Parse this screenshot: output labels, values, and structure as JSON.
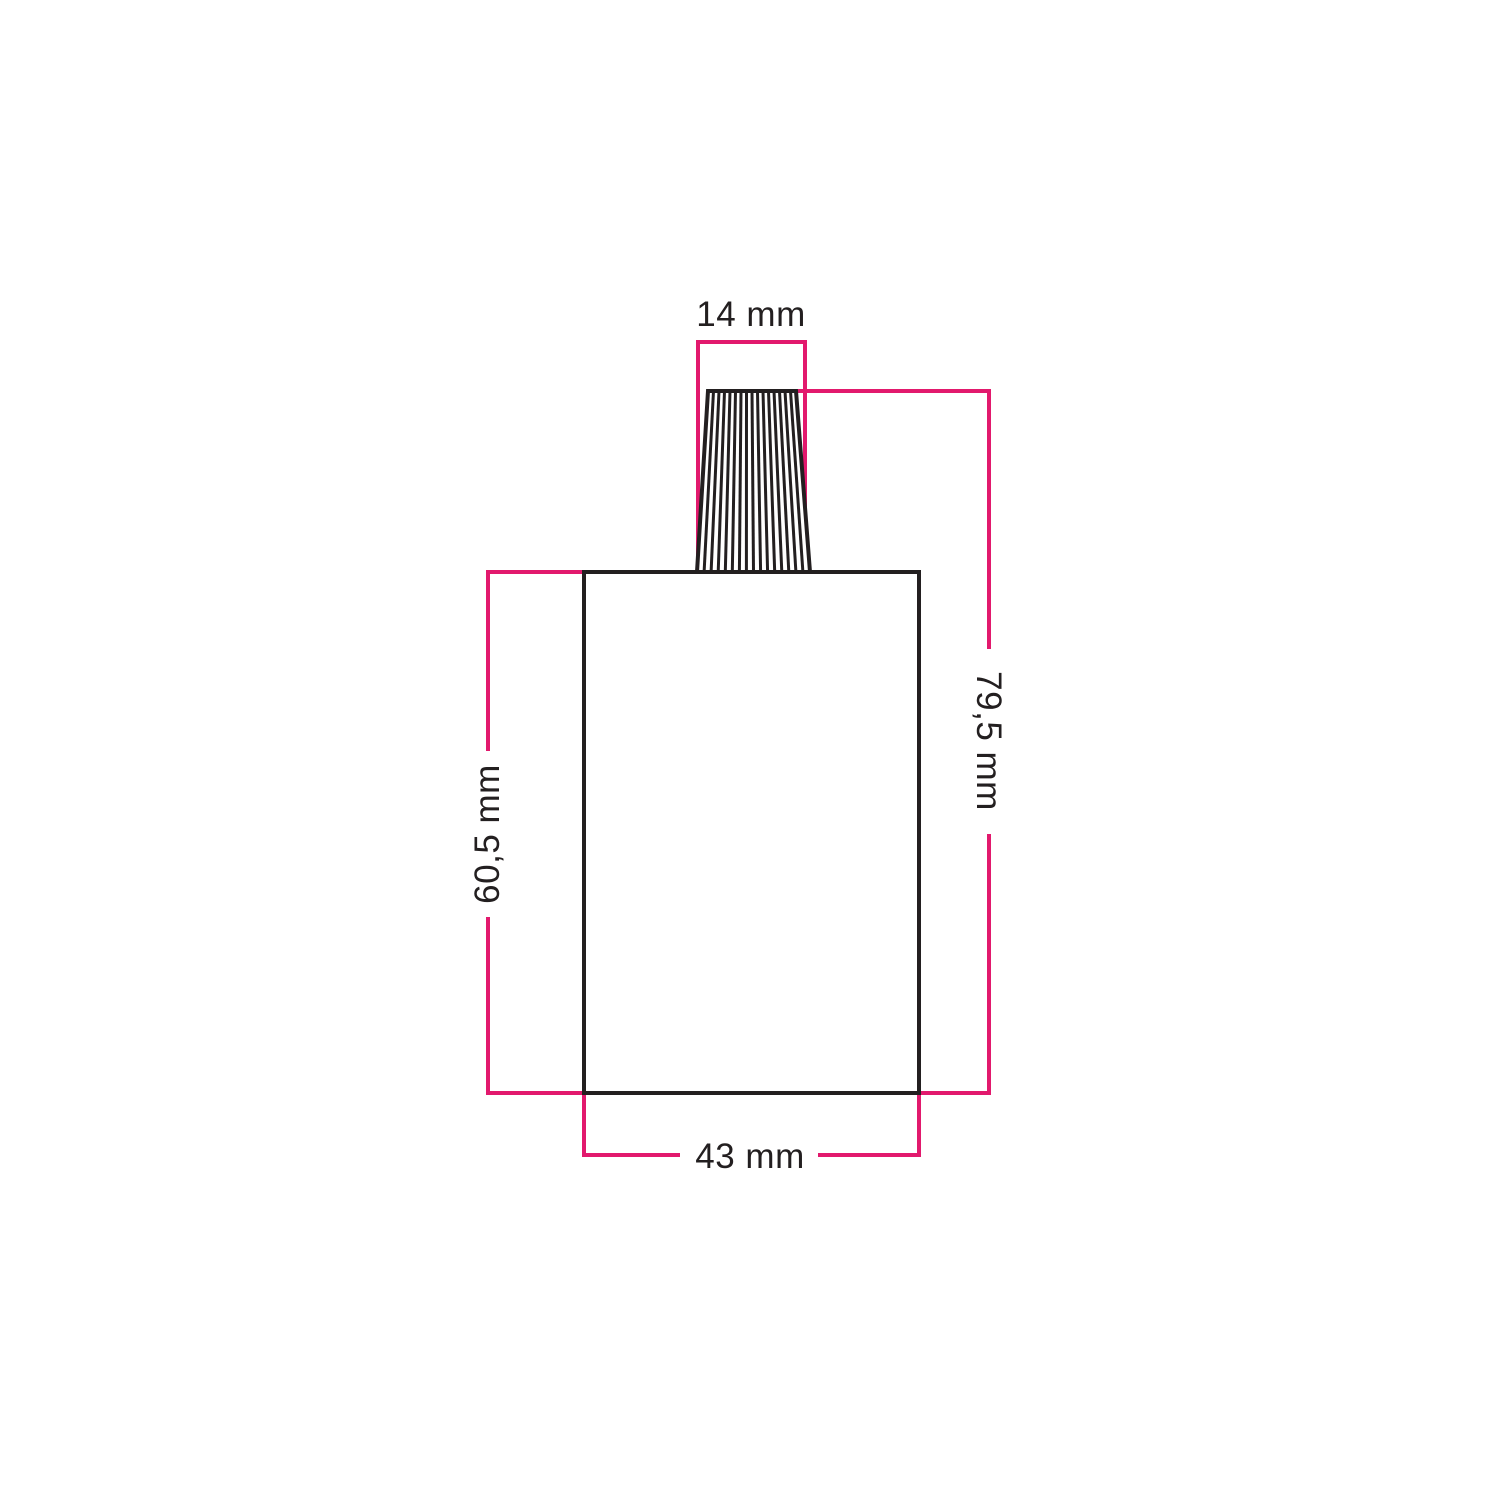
{
  "diagram": {
    "type": "technical-dimension-drawing",
    "labels": {
      "top_width": "14 mm",
      "total_height": "79,5 mm",
      "body_height": "60,5 mm",
      "body_width": "43 mm"
    },
    "values_mm": {
      "top_width": 14,
      "total_height": 79.5,
      "body_height": 60.5,
      "body_width": 43
    },
    "colors": {
      "dimension_line": "#e2196d",
      "drawing_line": "#231f20",
      "label_text": "#231f20",
      "background": "#ffffff"
    }
  }
}
